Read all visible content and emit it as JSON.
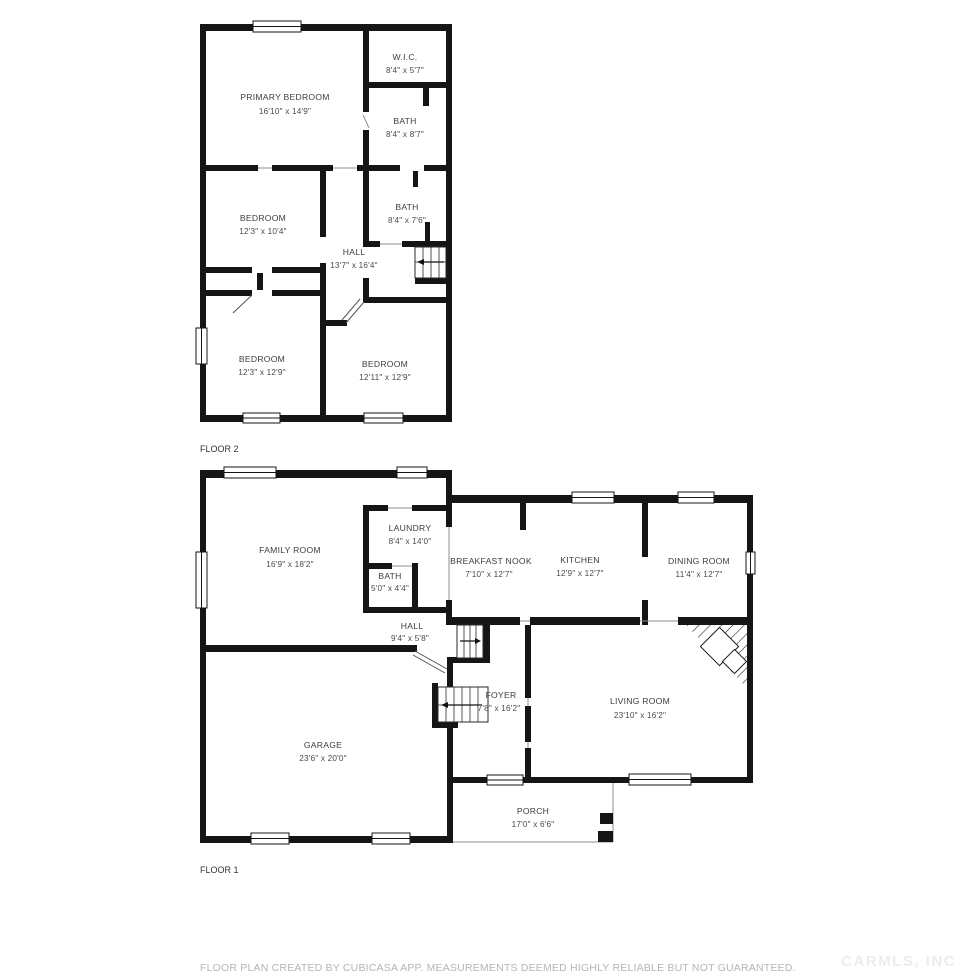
{
  "colors": {
    "wall": "#151515",
    "label_text": "#3d3d3d",
    "footer_text": "#b5b5b5",
    "watermark_text": "#ececec",
    "background": "#ffffff"
  },
  "floor2": {
    "label": "FLOOR 2",
    "rooms": [
      {
        "name": "PRIMARY BEDROOM",
        "dims": "16'10\" x 14'9\""
      },
      {
        "name": "W.I.C.",
        "dims": "8'4\" x 5'7\""
      },
      {
        "name": "BATH",
        "dims": "8'4\" x 8'7\""
      },
      {
        "name": "BEDROOM",
        "dims": "12'3\" x 10'4\""
      },
      {
        "name": "BATH",
        "dims": "8'4\" x 7'6\""
      },
      {
        "name": "HALL",
        "dims": "13'7\" x 16'4\""
      },
      {
        "name": "BEDROOM",
        "dims": "12'3\" x 12'9\""
      },
      {
        "name": "BEDROOM",
        "dims": "12'11\" x 12'9\""
      }
    ]
  },
  "floor1": {
    "label": "FLOOR 1",
    "rooms": [
      {
        "name": "FAMILY ROOM",
        "dims": "16'9\" x 18'2\""
      },
      {
        "name": "LAUNDRY",
        "dims": "8'4\" x 14'0\""
      },
      {
        "name": "BATH",
        "dims": "5'0\" x 4'4\""
      },
      {
        "name": "BREAKFAST NOOK",
        "dims": "7'10\" x 12'7\""
      },
      {
        "name": "KITCHEN",
        "dims": "12'9\" x 12'7\""
      },
      {
        "name": "DINING ROOM",
        "dims": "11'4\" x 12'7\""
      },
      {
        "name": "HALL",
        "dims": "9'4\" x 5'8\""
      },
      {
        "name": "FOYER",
        "dims": "7'8\" x 16'2\""
      },
      {
        "name": "LIVING ROOM",
        "dims": "23'10\" x 16'2\""
      },
      {
        "name": "GARAGE",
        "dims": "23'6\" x 20'0\""
      },
      {
        "name": "PORCH",
        "dims": "17'0\" x 6'6\""
      }
    ]
  },
  "footer": "FLOOR PLAN CREATED BY CUBICASA APP. MEASUREMENTS DEEMED HIGHLY RELIABLE BUT NOT GUARANTEED.",
  "watermark": "CARMLS, INC"
}
